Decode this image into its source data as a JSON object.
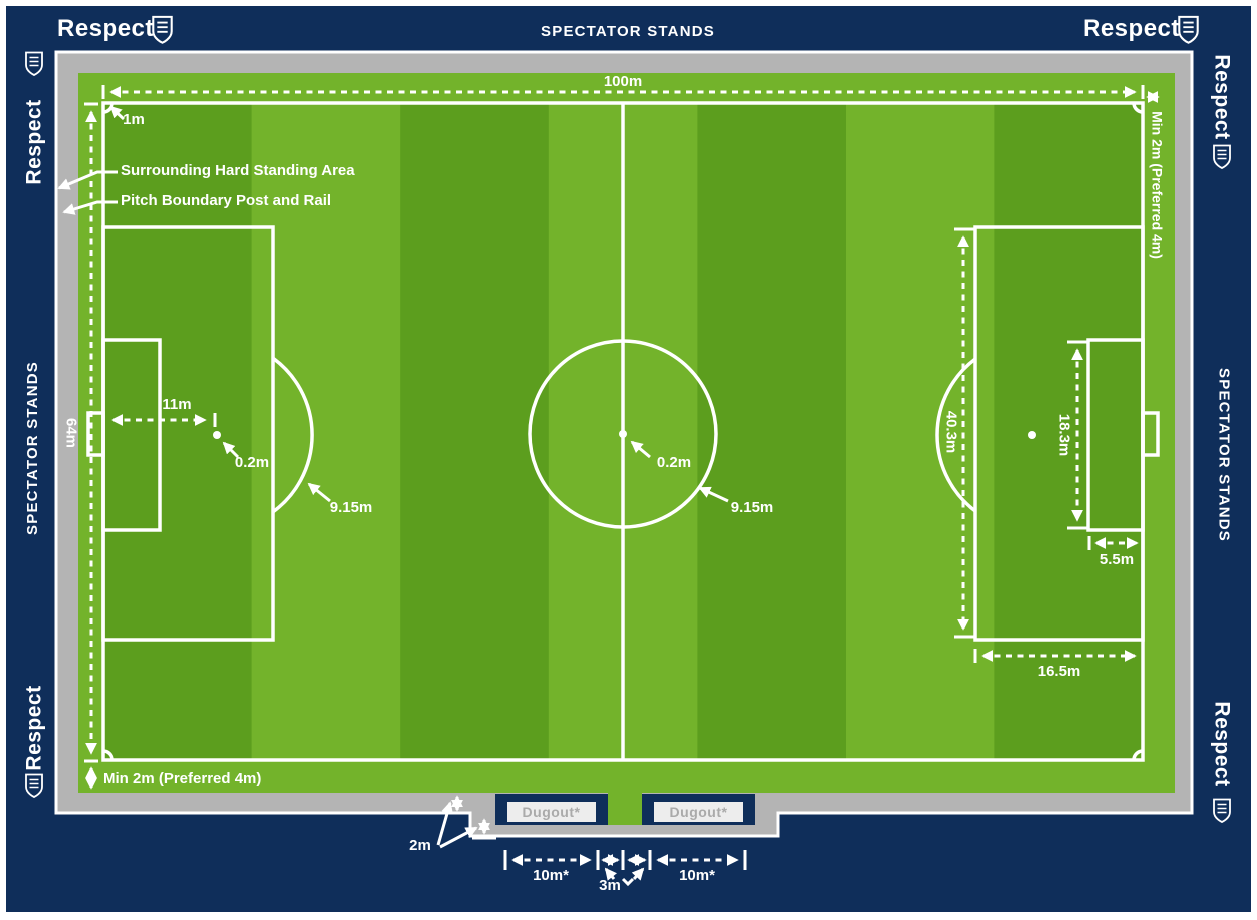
{
  "title": "FA Respect pitch dimensions diagram",
  "colors": {
    "navy": "#0f2e5a",
    "green_light": "#73b32b",
    "green_dark": "#5c9e1e",
    "gray": "#b4b4b4",
    "white": "#ffffff",
    "dugout_label_bg": "#ededed",
    "dugout_label_text": "#aaaaaa"
  },
  "frame": {
    "respect": "Respect",
    "spectator_stands": "SPECTATOR STANDS"
  },
  "annotations": {
    "pitch_length": "100m",
    "boundary_offset": "1m",
    "hard_standing": "Surrounding Hard Standing Area",
    "post_and_rail": "Pitch Boundary Post and Rail",
    "pitch_width": "64m",
    "penalty_spot_distance": "11m",
    "penalty_spot_diameter": "0.2m",
    "penalty_arc_radius": "9.15m",
    "centre_spot_diameter": "0.2m",
    "centre_circle_radius": "9.15m",
    "penalty_area_width": "40.3m",
    "goal_area_width": "18.3m",
    "goal_area_depth": "5.5m",
    "penalty_area_depth": "16.5m",
    "runoff_bottom": "Min 2m (Preferred 4m)",
    "runoff_right": "Min 2m (Preferred 4m)",
    "dugout_width_left": "10m*",
    "dugout_width_right": "10m*",
    "dugout_gap": "3m",
    "standing_depth": "2m"
  },
  "dugouts": {
    "left_label": "Dugout*",
    "right_label": "Dugout*"
  }
}
